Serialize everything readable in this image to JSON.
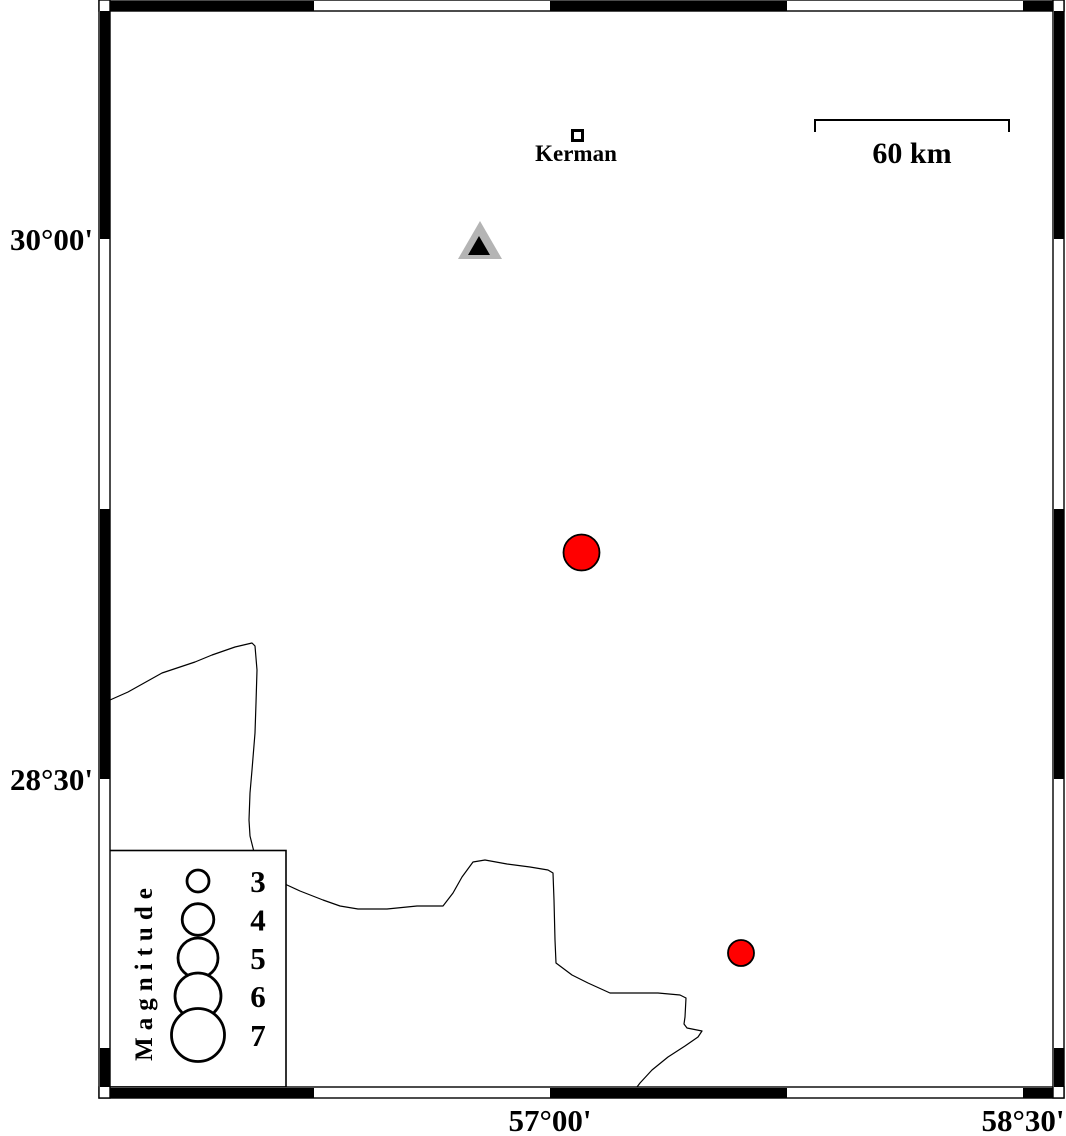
{
  "colors": {
    "earthquake_red": "#ff0000",
    "station_gray": "#b4b4b4",
    "line_black": "#000000"
  },
  "axis_labels": {
    "left": [
      {
        "text": "30°00'"
      },
      {
        "text": "28°30'"
      }
    ],
    "bottom": [
      {
        "text": "57°00'"
      },
      {
        "text": "58°30'"
      }
    ]
  },
  "scale_bar": {
    "label": "60 km",
    "path": "M815,132 L815,120 L1009,120 L1009,132"
  },
  "city": {
    "label": "Kerman"
  },
  "station": {
    "outer_points": "480,221 458,259 502,259",
    "inner_points": "479,236 468,255 490,255"
  },
  "earthquakes": [
    {
      "cx": 581.5,
      "cy": 552.5,
      "r": 18
    },
    {
      "cx": 741,
      "cy": 953,
      "r": 13
    }
  ],
  "legend": {
    "title": "Magnitude",
    "circle_x": 198,
    "label_x": 258,
    "rows": [
      {
        "label": "3",
        "cy": 881,
        "r": 11
      },
      {
        "label": "4",
        "cy": 919.5,
        "r": 15.8
      },
      {
        "label": "5",
        "cy": 958,
        "r": 20
      },
      {
        "label": "6",
        "cy": 996,
        "r": 23
      },
      {
        "label": "7",
        "cy": 1035,
        "r": 26.5
      }
    ]
  },
  "boundary_line": {
    "path": "M110,700 L128,692 L162,673 L195,662 L212,655 L235,647 L252,643 L255,646 L257,670 L256,703 L255,733 L252,770 L250,793 L249,820 L250,836 L254,852 L262,866 L275,878 L287,885 L300,891 L323,900 L340,906 L358,909 L387,909 L417,906 L443,906 L453,893 L462,877 L473,862 L485,860 L507,864 L530,867 L548,870 L553,873 L554,900 L555,940 L556,963 L572,975 L588,983 L610,993 L658,993 L680,995 L686,998 L685,1017 L684,1024 L687,1028 L702,1031 L698,1037 L685,1046 L668,1057 L652,1070 L640,1083 L637,1087"
  }
}
